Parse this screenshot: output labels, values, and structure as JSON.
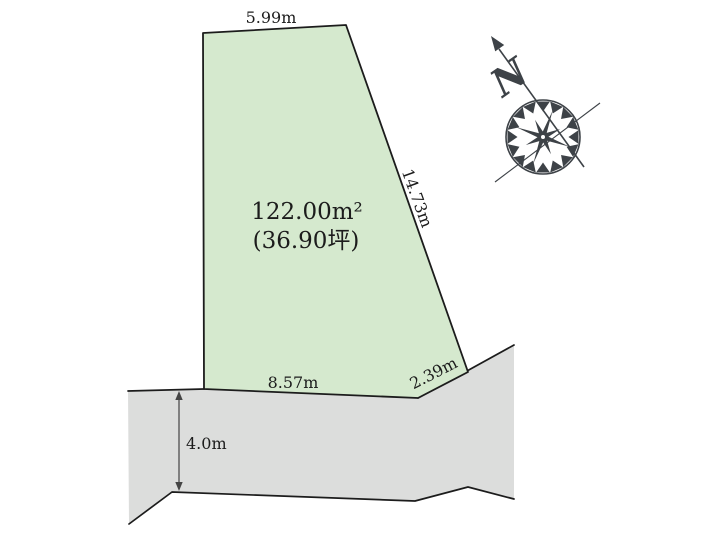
{
  "diagram": {
    "background": "#ffffff",
    "line_color": "#1c1c1c",
    "parcel": {
      "fill": "#d5e9ce",
      "area_label": "122.00m²",
      "tsubo_label": "(36.90坪)",
      "top_edge_label": "5.99m",
      "right_edge_label": "14.73m",
      "bottom_edge_label": "8.57m",
      "bottom_right_edge_label": "2.39m"
    },
    "road": {
      "fill": "#dcdddc",
      "width_label": "4.0m"
    },
    "compass": {
      "north_label": "N",
      "color": "#3d4247"
    }
  }
}
